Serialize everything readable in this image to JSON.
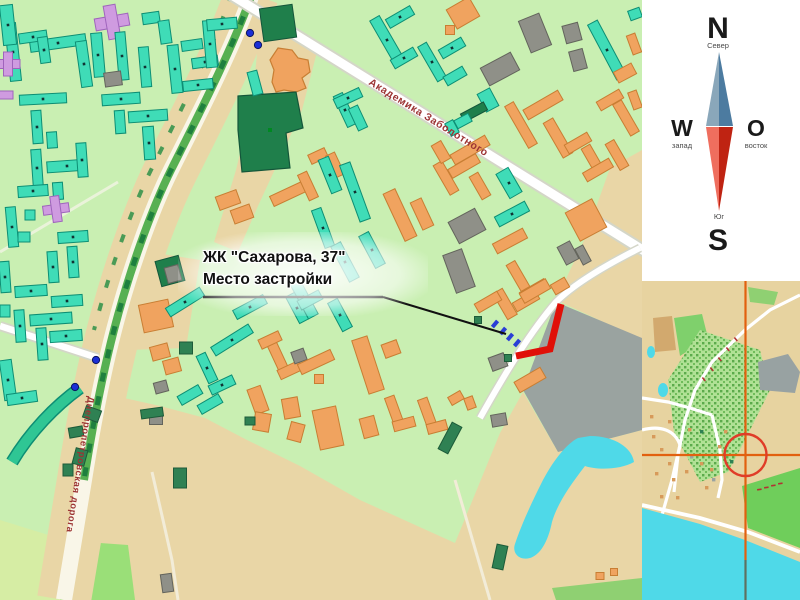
{
  "callout": {
    "line1": "ЖК \"Сахарова, 37\"",
    "line2": "Место застройки"
  },
  "streets": {
    "avenue": "Академика Заболотного",
    "road": "Днепропетровская дорога"
  },
  "compass": {
    "n": "N",
    "w": "W",
    "o": "O",
    "s": "S",
    "north_sub": "Север",
    "west_sub": "запад",
    "east_sub": "восток",
    "south_sub": "Юг"
  },
  "palette": {
    "map_green": "#c9efb2",
    "field_tan": "#e9d6a6",
    "pale_field": "#d6eda4",
    "bright_field": "#9adf78",
    "industrial_gray": "#9aa3a0",
    "water_cyan": "#4fd9e8",
    "site_marker_red": "#e01008",
    "street_label_red": "#9c3434",
    "crosshair_orange": "#e2600f",
    "buildings": {
      "t": [
        "#3fdcb7",
        "#0d8e74"
      ],
      "o": [
        "#f0a35f",
        "#c87e33"
      ],
      "g": [
        "#8f9088",
        "#63645c"
      ],
      "d": [
        "#1f7f4b",
        "#14563a"
      ],
      "p": [
        "#cf9be0",
        "#9f64bc"
      ],
      "m": [
        "#2f8153",
        "#1d5b39"
      ]
    }
  },
  "main_map": {
    "site_marker_points": "561,304 550,349 516,356",
    "callout_underline": [
      203,
      297,
      383,
      297
    ],
    "callout_pointer": [
      383,
      297,
      506,
      334
    ],
    "blue_dots": [
      [
        250,
        33
      ],
      [
        258,
        45
      ],
      [
        96,
        360
      ],
      [
        75,
        387
      ]
    ],
    "house_marks": [
      [
        495,
        324
      ],
      [
        503,
        331
      ],
      [
        510,
        337
      ],
      [
        517,
        343
      ]
    ],
    "buildings": [
      [
        "t",
        13,
        52,
        11,
        58,
        -6
      ],
      [
        "t",
        58,
        43,
        56,
        11,
        -8
      ],
      [
        "t",
        84,
        64,
        11,
        46,
        -8
      ],
      [
        "t",
        8,
        25,
        13,
        40,
        -6
      ],
      [
        "t",
        33,
        37,
        28,
        10,
        -8
      ],
      [
        "t",
        44,
        50,
        10,
        26,
        -8
      ],
      [
        "p",
        8,
        64,
        24,
        9,
        0
      ],
      [
        "p",
        8,
        64,
        9,
        24,
        0
      ],
      [
        "p",
        5,
        95,
        16,
        8,
        0
      ],
      [
        "t",
        98,
        55,
        11,
        44,
        -5
      ],
      [
        "p",
        112,
        22,
        34,
        12,
        -10
      ],
      [
        "p",
        112,
        22,
        12,
        34,
        -10
      ],
      [
        "t",
        122,
        56,
        10,
        48,
        -5
      ],
      [
        "t",
        151,
        18,
        17,
        11,
        -8
      ],
      [
        "t",
        165,
        32,
        11,
        23,
        -8
      ],
      [
        "t",
        145,
        67,
        10,
        40,
        -5
      ],
      [
        "g",
        113,
        79,
        17,
        14,
        -8
      ],
      [
        "t",
        192,
        45,
        21,
        10,
        -8
      ],
      [
        "t",
        175,
        69,
        11,
        48,
        -6
      ],
      [
        "t",
        205,
        62,
        26,
        10,
        -8
      ],
      [
        "t",
        210,
        44,
        11,
        47,
        -5
      ],
      [
        "t",
        222,
        24,
        30,
        11,
        -5
      ],
      [
        "t",
        198,
        85,
        30,
        10,
        -6
      ],
      [
        "t",
        43,
        99,
        47,
        10,
        -3
      ],
      [
        "t",
        37,
        127,
        10,
        33,
        -4
      ],
      [
        "t",
        52,
        140,
        10,
        16,
        -4
      ],
      [
        "t",
        121,
        99,
        38,
        11,
        -4
      ],
      [
        "t",
        120,
        122,
        10,
        23,
        -4
      ],
      [
        "t",
        148,
        116,
        39,
        11,
        -4
      ],
      [
        "t",
        149,
        143,
        11,
        33,
        -4
      ],
      [
        "t",
        37,
        168,
        10,
        37,
        -4
      ],
      [
        "t",
        67,
        166,
        40,
        11,
        -4
      ],
      [
        "t",
        82,
        160,
        10,
        34,
        -4
      ],
      [
        "t",
        33,
        191,
        30,
        11,
        -4
      ],
      [
        "t",
        58,
        191,
        10,
        17,
        -4
      ],
      [
        "t",
        12,
        227,
        10,
        40,
        -5
      ],
      [
        "t",
        30,
        215,
        10,
        10,
        0
      ],
      [
        "t",
        24,
        237,
        12,
        10,
        0
      ],
      [
        "p",
        56,
        209,
        26,
        9,
        -8
      ],
      [
        "p",
        56,
        209,
        9,
        26,
        -8
      ],
      [
        "t",
        73,
        237,
        30,
        11,
        -4
      ],
      [
        "t",
        73,
        262,
        10,
        31,
        -4
      ],
      [
        "t",
        53,
        267,
        10,
        31,
        -4
      ],
      [
        "t",
        5,
        277,
        10,
        31,
        -4
      ],
      [
        "t",
        31,
        291,
        32,
        11,
        -4
      ],
      [
        "t",
        67,
        301,
        31,
        11,
        -4
      ],
      [
        "t",
        20,
        326,
        10,
        32,
        -4
      ],
      [
        "t",
        51,
        319,
        42,
        11,
        -4
      ],
      [
        "t",
        42,
        344,
        10,
        32,
        -4
      ],
      [
        "t",
        66,
        336,
        32,
        11,
        -4
      ],
      [
        "t",
        5,
        311,
        10,
        12,
        0
      ],
      [
        "t",
        8,
        380,
        12,
        40,
        -8
      ],
      [
        "t",
        22,
        398,
        30,
        11,
        -8
      ],
      [
        "d",
        278,
        23,
        33,
        33,
        -8
      ],
      [
        "t",
        255,
        83,
        10,
        24,
        -15
      ],
      [
        "o",
        156,
        316,
        30,
        28,
        -12
      ],
      [
        "d",
        170,
        271,
        24,
        26,
        -15
      ],
      [
        "g",
        173,
        274,
        14,
        16,
        -15
      ],
      [
        "o",
        228,
        200,
        22,
        14,
        -20
      ],
      [
        "o",
        242,
        214,
        20,
        14,
        -20
      ],
      [
        "t",
        387,
        40,
        11,
        50,
        -30
      ],
      [
        "t",
        400,
        17,
        28,
        10,
        -30
      ],
      [
        "t",
        404,
        58,
        26,
        10,
        -30
      ],
      [
        "o",
        463,
        13,
        26,
        22,
        -30
      ],
      [
        "o",
        450,
        30,
        9,
        9,
        0
      ],
      [
        "g",
        535,
        33,
        22,
        34,
        -22
      ],
      [
        "g",
        572,
        33,
        16,
        18,
        -15
      ],
      [
        "g",
        578,
        60,
        14,
        20,
        -15
      ],
      [
        "g",
        500,
        69,
        34,
        20,
        -28
      ],
      [
        "t",
        607,
        50,
        11,
        62,
        -28
      ],
      [
        "o",
        625,
        73,
        20,
        12,
        -28
      ],
      [
        "t",
        432,
        62,
        10,
        40,
        -30
      ],
      [
        "t",
        452,
        48,
        26,
        10,
        -30
      ],
      [
        "t",
        455,
        76,
        22,
        10,
        -30
      ],
      [
        "t",
        635,
        14,
        12,
        10,
        -20
      ],
      [
        "o",
        634,
        44,
        9,
        20,
        -20
      ],
      [
        "o",
        635,
        100,
        9,
        18,
        -20
      ],
      [
        "t",
        488,
        100,
        14,
        20,
        -28
      ],
      [
        "d",
        474,
        112,
        26,
        9,
        -28
      ],
      [
        "t",
        463,
        121,
        16,
        9,
        -28
      ],
      [
        "t",
        452,
        128,
        9,
        14,
        -28
      ],
      [
        "o",
        521,
        125,
        10,
        48,
        -30
      ],
      [
        "o",
        543,
        105,
        40,
        11,
        -30
      ],
      [
        "o",
        558,
        138,
        11,
        40,
        -30
      ],
      [
        "o",
        610,
        100,
        26,
        10,
        -30
      ],
      [
        "o",
        626,
        118,
        10,
        36,
        -30
      ],
      [
        "o",
        578,
        143,
        26,
        10,
        -30
      ],
      [
        "o",
        592,
        158,
        10,
        26,
        -30
      ],
      [
        "o",
        598,
        170,
        30,
        10,
        -30
      ],
      [
        "o",
        617,
        155,
        10,
        30,
        -30
      ],
      [
        "o",
        470,
        150,
        40,
        11,
        -30
      ],
      [
        "o",
        446,
        178,
        10,
        34,
        -30
      ],
      [
        "o",
        464,
        166,
        32,
        10,
        -30
      ],
      [
        "o",
        480,
        186,
        10,
        26,
        -30
      ],
      [
        "o",
        441,
        152,
        11,
        20,
        -30
      ],
      [
        "t",
        345,
        110,
        10,
        34,
        -25
      ],
      [
        "t",
        348,
        98,
        28,
        10,
        -25
      ],
      [
        "t",
        358,
        118,
        10,
        24,
        -25
      ],
      [
        "o",
        318,
        156,
        18,
        10,
        -25
      ],
      [
        "o",
        335,
        165,
        10,
        24,
        -25
      ],
      [
        "t",
        355,
        192,
        11,
        60,
        -20
      ],
      [
        "t",
        330,
        175,
        11,
        36,
        -22
      ],
      [
        "t",
        323,
        228,
        10,
        40,
        -20
      ],
      [
        "o",
        290,
        193,
        40,
        11,
        -25
      ],
      [
        "o",
        308,
        186,
        10,
        28,
        -25
      ],
      [
        "o",
        400,
        215,
        13,
        52,
        -25
      ],
      [
        "o",
        422,
        214,
        12,
        30,
        -25
      ],
      [
        "g",
        467,
        226,
        30,
        24,
        -28
      ],
      [
        "g",
        459,
        271,
        20,
        40,
        -20
      ],
      [
        "t",
        509,
        183,
        14,
        28,
        -30
      ],
      [
        "t",
        512,
        214,
        34,
        11,
        -28
      ],
      [
        "o",
        510,
        241,
        34,
        11,
        -28
      ],
      [
        "g",
        568,
        253,
        14,
        20,
        -28
      ],
      [
        "g",
        583,
        255,
        9,
        18,
        -28
      ],
      [
        "o",
        586,
        220,
        30,
        32,
        -28
      ],
      [
        "o",
        518,
        276,
        10,
        30,
        -30
      ],
      [
        "o",
        534,
        290,
        28,
        10,
        -30
      ],
      [
        "o",
        526,
        301,
        26,
        10,
        -30
      ],
      [
        "t",
        303,
        297,
        11,
        44,
        -28
      ],
      [
        "t",
        345,
        262,
        11,
        40,
        -28
      ],
      [
        "t",
        372,
        250,
        11,
        36,
        -28
      ],
      [
        "t",
        250,
        307,
        34,
        10,
        -28
      ],
      [
        "t",
        185,
        302,
        40,
        10,
        -32
      ],
      [
        "t",
        232,
        340,
        44,
        10,
        -32
      ],
      [
        "t",
        207,
        368,
        10,
        30,
        -25
      ],
      [
        "t",
        222,
        385,
        26,
        10,
        -25
      ],
      [
        "t",
        190,
        395,
        24,
        10,
        -30
      ],
      [
        "t",
        210,
        404,
        24,
        10,
        -30
      ],
      [
        "m",
        186,
        348,
        13,
        12,
        0
      ],
      [
        "o",
        160,
        352,
        18,
        14,
        -15
      ],
      [
        "o",
        172,
        366,
        16,
        14,
        -15
      ],
      [
        "g",
        161,
        387,
        13,
        11,
        -15
      ],
      [
        "g",
        156,
        419,
        13,
        11,
        0
      ],
      [
        "t",
        297,
        308,
        10,
        30,
        -28
      ],
      [
        "t",
        310,
        300,
        24,
        10,
        -28
      ],
      [
        "t",
        340,
        315,
        11,
        32,
        -28
      ],
      [
        "o",
        277,
        355,
        10,
        36,
        -25
      ],
      [
        "o",
        290,
        370,
        24,
        10,
        -25
      ],
      [
        "o",
        270,
        340,
        22,
        10,
        -25
      ],
      [
        "g",
        299,
        356,
        13,
        12,
        -20
      ],
      [
        "o",
        316,
        362,
        36,
        11,
        -25
      ],
      [
        "o",
        319,
        379,
        9,
        9,
        0
      ],
      [
        "o",
        258,
        400,
        14,
        26,
        -20
      ],
      [
        "o",
        262,
        422,
        16,
        18,
        10
      ],
      [
        "o",
        291,
        408,
        16,
        20,
        -10
      ],
      [
        "o",
        296,
        432,
        14,
        18,
        15
      ],
      [
        "o",
        328,
        428,
        24,
        40,
        -12
      ],
      [
        "o",
        368,
        365,
        16,
        56,
        -18
      ],
      [
        "o",
        391,
        349,
        16,
        14,
        -20
      ],
      [
        "o",
        369,
        427,
        15,
        20,
        -15
      ],
      [
        "o",
        394,
        410,
        10,
        28,
        -20
      ],
      [
        "o",
        404,
        424,
        22,
        10,
        -15
      ],
      [
        "o",
        427,
        412,
        10,
        28,
        -20
      ],
      [
        "o",
        437,
        427,
        20,
        10,
        -15
      ],
      [
        "o",
        456,
        398,
        14,
        9,
        -30
      ],
      [
        "o",
        470,
        403,
        9,
        12,
        -20
      ],
      [
        "g",
        499,
        420,
        15,
        12,
        -10
      ],
      [
        "o",
        505,
        304,
        11,
        30,
        -30
      ],
      [
        "o",
        535,
        291,
        30,
        11,
        -30
      ],
      [
        "o",
        560,
        286,
        16,
        11,
        -30
      ],
      [
        "o",
        488,
        302,
        26,
        10,
        -30
      ],
      [
        "g",
        498,
        362,
        16,
        14,
        -20
      ],
      [
        "o",
        530,
        380,
        30,
        12,
        -30
      ],
      [
        "m",
        478,
        320,
        7,
        7,
        0
      ],
      [
        "m",
        508,
        358,
        7,
        7,
        0
      ],
      [
        "m",
        92,
        414,
        16,
        12,
        20
      ],
      [
        "m",
        76,
        432,
        14,
        10,
        -10
      ],
      [
        "m",
        80,
        457,
        12,
        16,
        15
      ],
      [
        "m",
        68,
        470,
        10,
        12,
        0
      ],
      [
        "m",
        152,
        413,
        22,
        9,
        -8
      ],
      [
        "m",
        180,
        478,
        13,
        20,
        0
      ],
      [
        "g",
        167,
        583,
        11,
        18,
        -8
      ],
      [
        "m",
        250,
        421,
        10,
        8,
        0
      ],
      [
        "m",
        450,
        438,
        11,
        30,
        28
      ],
      [
        "m",
        500,
        557,
        11,
        24,
        12
      ],
      [
        "o",
        600,
        576,
        8,
        7,
        0
      ],
      [
        "o",
        614,
        572,
        7,
        7,
        0
      ]
    ]
  },
  "inset": {
    "crosshair": {
      "x": 745.5,
      "y": 455,
      "radius": 21
    },
    "specks": [
      [
        652,
        435,
        0
      ],
      [
        660,
        448,
        0
      ],
      [
        668,
        462,
        0
      ],
      [
        655,
        472,
        0
      ],
      [
        672,
        478,
        0
      ],
      [
        685,
        470,
        0
      ],
      [
        690,
        455,
        1
      ],
      [
        700,
        462,
        0
      ],
      [
        710,
        468,
        0
      ],
      [
        718,
        445,
        0
      ],
      [
        700,
        430,
        2
      ],
      [
        688,
        428,
        0
      ],
      [
        660,
        495,
        0
      ],
      [
        676,
        496,
        0
      ],
      [
        705,
        486,
        0
      ],
      [
        730,
        460,
        2
      ],
      [
        712,
        478,
        1
      ],
      [
        668,
        420,
        0
      ],
      [
        650,
        415,
        0
      ],
      [
        724,
        430,
        0
      ]
    ],
    "label_dashes_road": [
      [
        735,
        337
      ],
      [
        727,
        347
      ],
      [
        719,
        357
      ],
      [
        711,
        367
      ],
      [
        703,
        377
      ]
    ],
    "label_dashes_coast": [
      [
        757,
        489
      ],
      [
        764,
        487
      ],
      [
        771,
        485
      ],
      [
        778,
        483
      ]
    ]
  }
}
